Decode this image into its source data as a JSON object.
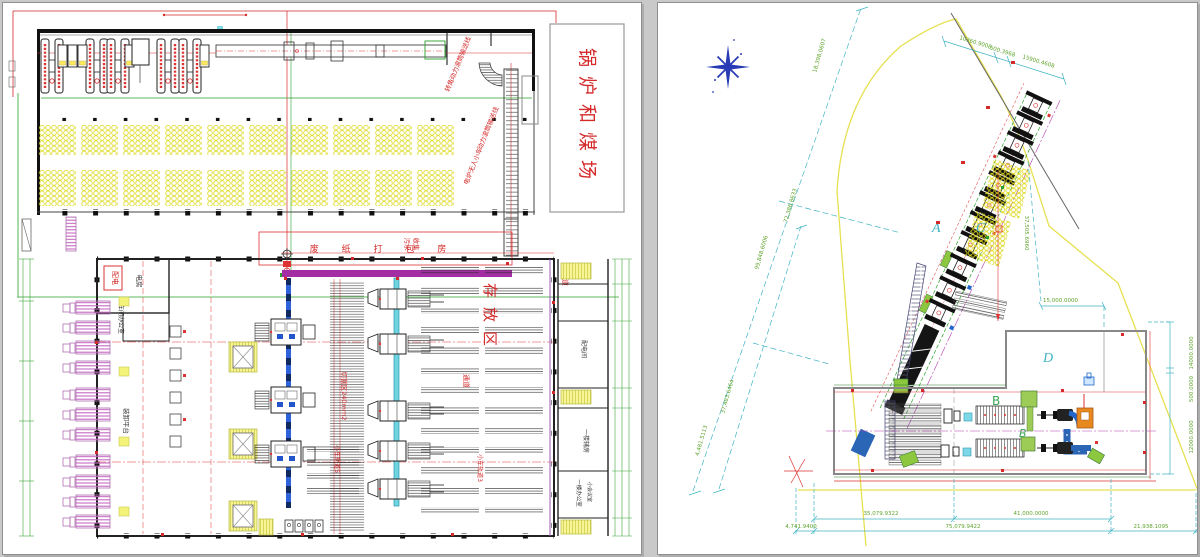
{
  "window": {
    "background": "#c9c9c9"
  },
  "left_sheet": {
    "area_label": "锅炉和煤场",
    "conveyor_label_corner": "转角动力滚筒输送线",
    "conveyor_label_power": "动力滚筒输送线",
    "conveyor_label_cart": "电炉无人小车",
    "baler_room": "废 纸 打 包 房",
    "sewage_col1": "污水",
    "sewage_col2": "收集",
    "power_box": "配电",
    "power_room_small": "电房",
    "workshop_office": "车间办公室",
    "loading_platform": "装卸平台",
    "cutting_zone": "切割区240mm2",
    "cart_track_3": "小车轨道3",
    "cart_track_5": "小车轨道5",
    "storage_zone": "存放区",
    "aisle_1": "通道",
    "aisle_2": "通道",
    "distribution_room": "配电间",
    "aux_room": "一楼辅房",
    "office_1f": "一楼办公室",
    "meeting_room": "小会议室"
  },
  "right_sheet": {
    "zones": {
      "a": "A",
      "b_upper": "B",
      "b_italic": "B",
      "c": "C",
      "d": "D"
    },
    "dimensions": {
      "top_diagonal": "18,398.0607",
      "top_right_1": "10360.9008",
      "top_right_2": "500.3968",
      "top_right_3": "15900.4608",
      "left_1": "72,386.8633",
      "left_2": "99,848.6006",
      "left_3": "37,483.6464",
      "left_4": "4,481.5113",
      "mid_right": "15,000.0000",
      "yard_height": "37,505.6960",
      "right_1": "14000.0000",
      "right_2": "500.0000",
      "right_3": "12000.0000",
      "bottom_top_1": "35,079.9322",
      "bottom_top_2": "41,000.0000",
      "bottom_1": "4,741.9400",
      "bottom_2": "75,079.9422",
      "bottom_3": "21,938.1095"
    }
  },
  "colors": {
    "red": "#d42a2a",
    "dim_green": "#5ea32c",
    "cyan": "#3fb3c3",
    "yellow": "#e8e34a",
    "magenta": "#a32ea3",
    "blue_rail": "#2a5fd0",
    "dock_pink": "#c569c5",
    "orange": "#e8891f",
    "compass_blue": "#2a3bb5"
  }
}
